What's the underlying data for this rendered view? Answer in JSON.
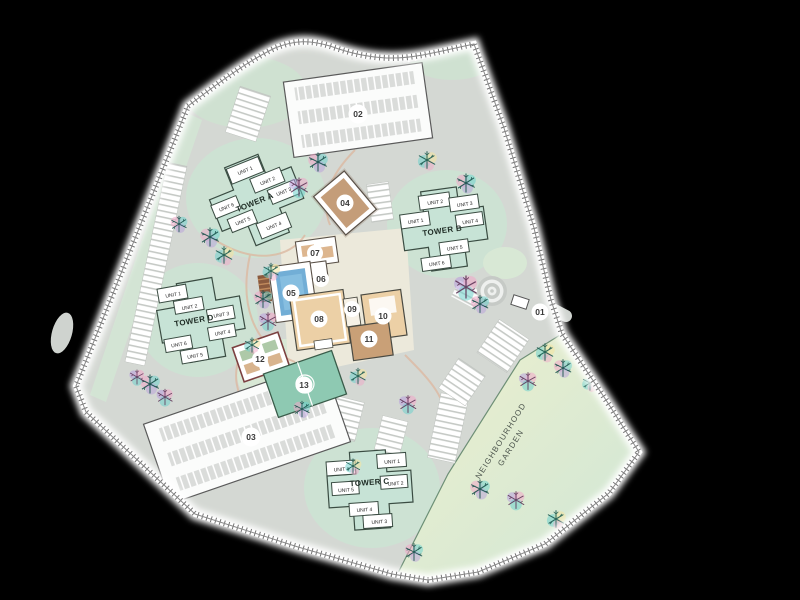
{
  "title": "Residential development site plan / master plan",
  "markers": [
    {
      "label": "01"
    },
    {
      "label": "02"
    },
    {
      "label": "03"
    },
    {
      "label": "04"
    },
    {
      "label": "05"
    },
    {
      "label": "06"
    },
    {
      "label": "07"
    },
    {
      "label": "08"
    },
    {
      "label": "09"
    },
    {
      "label": "10"
    },
    {
      "label": "11"
    },
    {
      "label": "12"
    },
    {
      "label": "13"
    }
  ],
  "towers": [
    {
      "name": "TOWER A",
      "units": [
        "UNIT 1",
        "UNIT 2",
        "UNIT 3",
        "UNIT 4",
        "UNIT 5",
        "UNIT 6"
      ]
    },
    {
      "name": "TOWER B",
      "units": [
        "UNIT 1",
        "UNIT 2",
        "UNIT 3",
        "UNIT 4",
        "UNIT 5",
        "UNIT 6"
      ]
    },
    {
      "name": "TOWER C",
      "units": [
        "UNIT 1",
        "UNIT 2",
        "UNIT 3",
        "UNIT 4",
        "UNIT 5",
        "UNIT 6"
      ]
    },
    {
      "name": "TOWER D",
      "units": [
        "UNIT 1",
        "UNIT 2",
        "UNIT 3",
        "UNIT 4",
        "UNIT 5",
        "UNIT 6"
      ]
    }
  ],
  "garden": {
    "line1": "NEIGHBOURHOOD",
    "line2": "GARDEN"
  },
  "colors": {
    "background": "#000000",
    "road": "#d4d8d3",
    "green": "#cfe1d1",
    "tower_mint": "#c7e3d6",
    "building_tan": "#ecd0a6",
    "building_brown": "#c9a077",
    "pool_blue": "#72aed6",
    "court_green": "#8ec9b2",
    "garden_yellow_green": "#ecf0cd",
    "tree_dark_teal": "#17504a"
  }
}
